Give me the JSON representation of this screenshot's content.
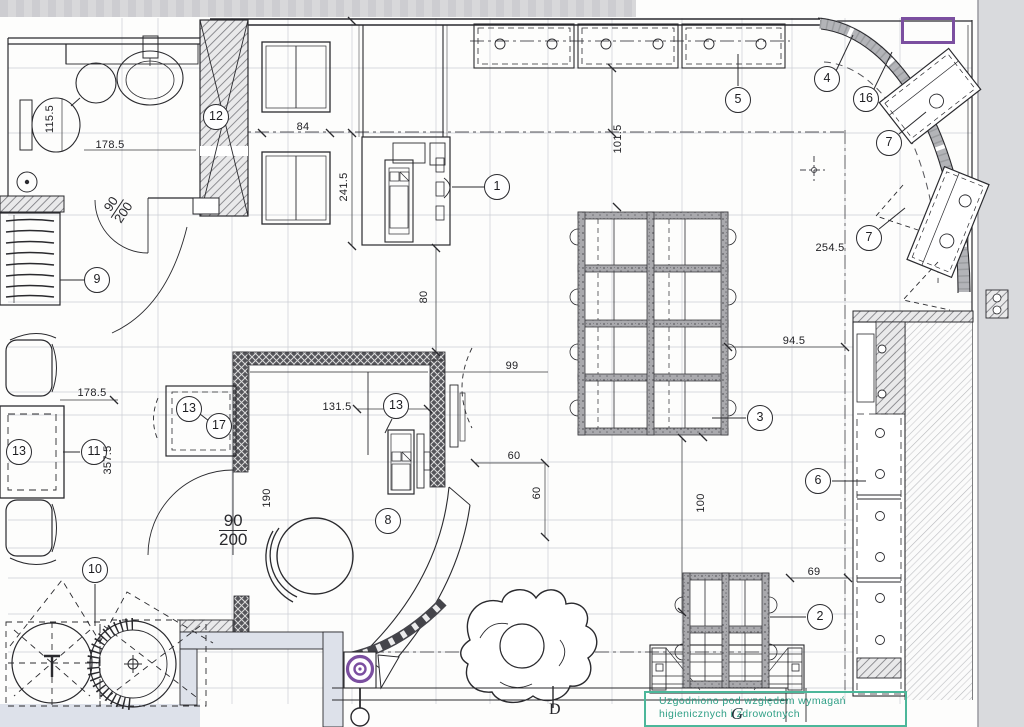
{
  "document": {
    "kind": "scanned architectural floor plan"
  },
  "callouts": {
    "c1": "1",
    "c2": "2",
    "c3": "3",
    "c4": "4",
    "c5": "5",
    "c6": "6",
    "c7a": "7",
    "c7b": "7",
    "c8": "8",
    "c9": "9",
    "c10": "10",
    "c11": "11",
    "c12": "12",
    "c13a": "13",
    "c13b": "13",
    "c13c": "13",
    "c16": "16",
    "c17": "17"
  },
  "dimensions": {
    "d115": "115.5",
    "d178a": "178.5",
    "d84": "84",
    "d241": "241.5",
    "d101": "101.5",
    "d254": "254.5",
    "d94": "94.5",
    "d99": "99",
    "d80": "80",
    "d178b": "178.5",
    "d357": "357.5",
    "d131": "131.5",
    "d190": "190",
    "d60a": "60",
    "d60b": "60",
    "d100": "100",
    "d69": "69"
  },
  "doors": {
    "a": {
      "w": "90",
      "h": "200"
    },
    "b": {
      "w": "90",
      "h": "200"
    }
  },
  "grid_letters": {
    "d": "D"
  },
  "stamp": {
    "line1": "Uzgodniono pod względem wymagań",
    "line2": "higienicznych i zdrowotnych",
    "mark": "G"
  },
  "colors": {
    "annotation_purple": "#7b4fa0",
    "stamp_green": "#2f9f86",
    "ink": "#2a2a2e",
    "wall_gray": "#a7a7ab",
    "paper": "#fdfdfc"
  }
}
